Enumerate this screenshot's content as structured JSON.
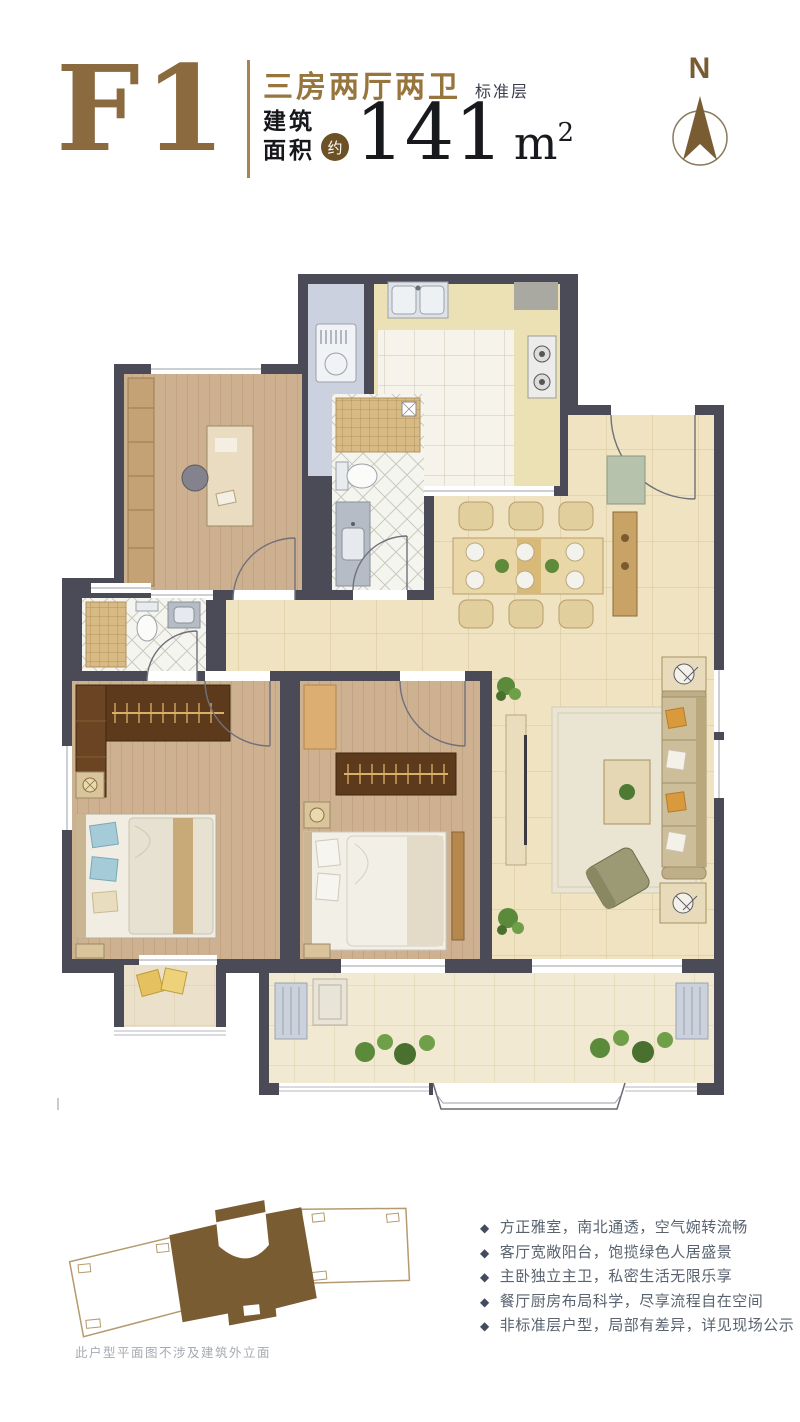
{
  "header": {
    "unit_code": "F1",
    "layout_title": "三房两厅两卫",
    "floor_note": "标准层",
    "area_label_line1": "建筑",
    "area_label_line2": "面积",
    "approx_badge": "约",
    "area_value": "141",
    "area_unit": "m",
    "area_sup": "2"
  },
  "compass": {
    "north_label": "N"
  },
  "features_bullet": "◆",
  "features": [
    "方正雅室，南北通透，空气婉转流畅",
    "客厅宽敞阳台，饱揽绿色人居盛景",
    "主卧独立主卫，私密生活无限乐享",
    "餐厅厨房布局科学，尽享流程自在空间",
    "非标准层户型，局部有差异，详见现场公示"
  ],
  "site_plan": {
    "disclaimer": "此户型平面图不涉及建筑外立面"
  },
  "colors": {
    "brand_gold": "#97763e",
    "unit_code_brown": "#8a6a3e",
    "badge_brown": "#6d5126",
    "text_dark": "#15171b",
    "wall_dark": "#4b4b57",
    "feature_text": "#59636f",
    "site_plan_brown": "#7a5c33",
    "wood_floor": "#cdb191",
    "marble_floor": "#efe3c1",
    "kitchen_floor": "#ebe0b0"
  }
}
